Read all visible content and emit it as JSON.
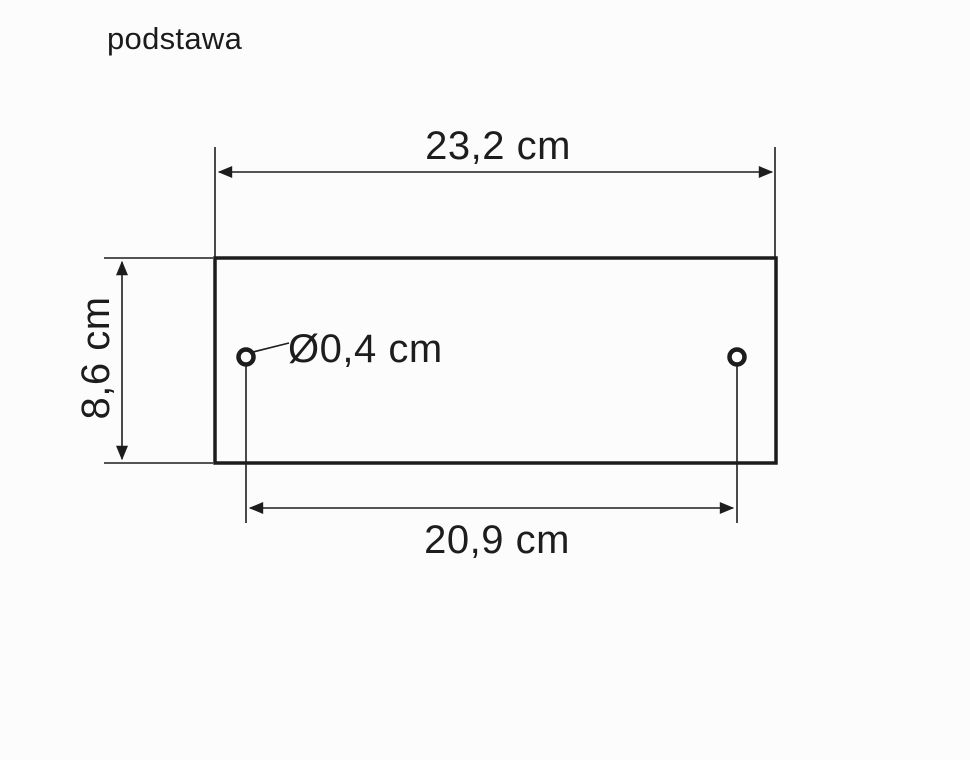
{
  "title": "podstawa",
  "drawing": {
    "kind": "technical-dimension-drawing",
    "part_label": "podstawa",
    "labels": {
      "width": "23,2 cm",
      "height": "8,6 cm",
      "hole_spacing": "20,9 cm",
      "hole_diameter": "Ø0,4 cm"
    },
    "values": {
      "width_cm": 23.2,
      "height_cm": 8.6,
      "hole_spacing_cm": 20.9,
      "hole_diameter_cm": 0.4,
      "hole_count": 2,
      "unit": "cm"
    }
  },
  "colors": {
    "background": "#fcfcfc",
    "ink": "#1d1d1d"
  }
}
